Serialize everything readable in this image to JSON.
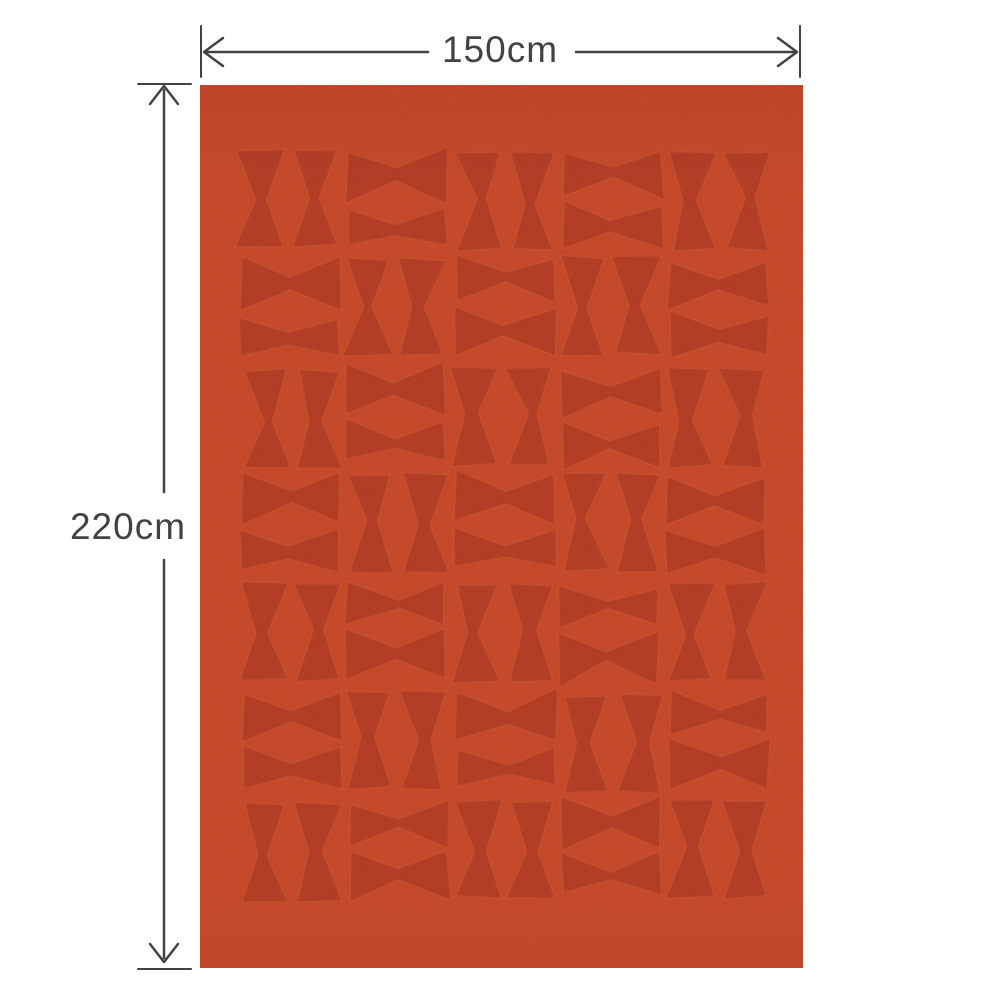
{
  "diagram": {
    "type": "product-size-diagram",
    "width_label": "150cm",
    "height_label": "220cm",
    "annotation_color": "#424242"
  },
  "blanket": {
    "base_color": "#c44727",
    "motif_color": "#b23a20",
    "motif_outline_color": "rgba(225,120,80,0.30)",
    "pattern_name": "bowtie-hourglass-grid",
    "pattern_grid": [
      "VHVHV",
      "HVHVH",
      "VHVHV",
      "HVHVH",
      "VHVHV",
      "HVHVH",
      "VHVHV"
    ]
  }
}
